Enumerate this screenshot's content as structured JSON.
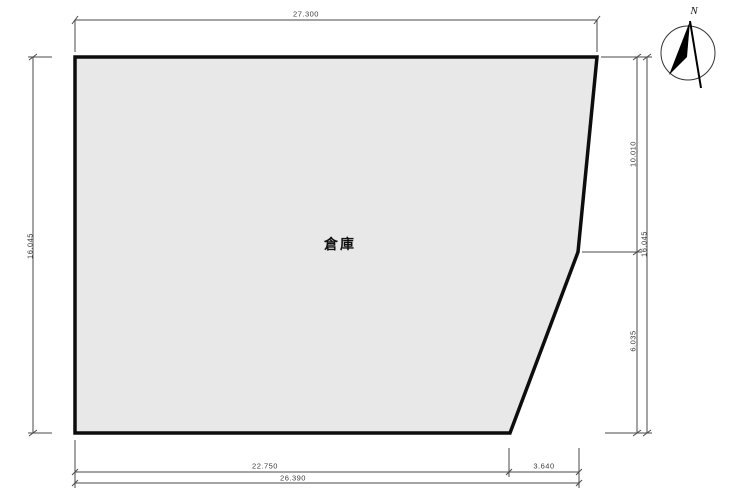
{
  "drawing": {
    "type": "site-plan",
    "building_label": "倉庫",
    "north_label": "N",
    "dimensions": {
      "top": "27.300",
      "left": "16.045",
      "right_upper": "10.010",
      "right_lower": "6.035",
      "right_total": "16.045",
      "bottom_main": "22.750",
      "bottom_slant": "3.640",
      "bottom_total": "26.390"
    },
    "colors": {
      "building_fill": "#e8e8e8",
      "building_outline": "#0d0d0d",
      "dimension_line": "#4a4a4a",
      "background": "#ffffff"
    }
  }
}
